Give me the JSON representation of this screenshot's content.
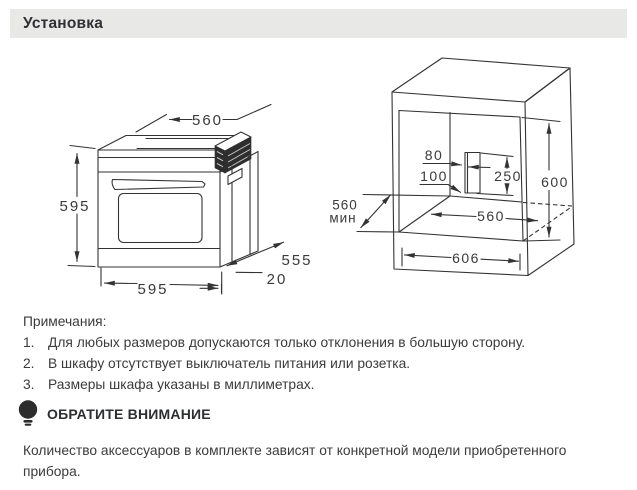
{
  "header": {
    "title": "Установка"
  },
  "diagrams": {
    "oven": {
      "top_width": "560",
      "height": "595",
      "bottom_width": "595",
      "depth": "555",
      "front_offset": "20"
    },
    "cabinet": {
      "cutout_width": "80",
      "cutout_offset": "100",
      "cutout_height": "250",
      "niche_height": "600",
      "depth_min": "560",
      "depth_min_label": "мин",
      "niche_width": "560",
      "outer_width": "606"
    }
  },
  "notes": {
    "title": "Примечания:",
    "items": [
      {
        "num": "1.",
        "text": "Для любых размеров допускаются только отклонения в большую сторону."
      },
      {
        "num": "2.",
        "text": "В шкафу отсутствует выключатель питания или розетка."
      },
      {
        "num": "3.",
        "text": "Размеры шкафа указаны в миллиметрах."
      }
    ]
  },
  "attention": {
    "icon": "lightbulb-icon",
    "title": "ОБРАТИТЕ ВНИМАНИЕ",
    "body": "Количество аксессуаров в комплекте зависят от конкретной модели приобретенного прибора."
  },
  "colors": {
    "header_bg": "#e8e8e6",
    "text": "#3b3b3b",
    "line": "#333333"
  }
}
